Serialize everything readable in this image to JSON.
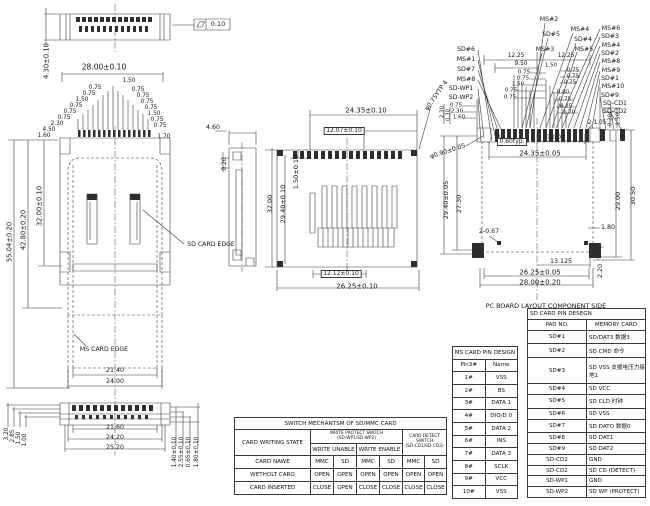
{
  "drawing": {
    "flatness_tolerance": "0.10",
    "annotations": [
      {
        "t": "SD CARD EDGE",
        "x": 211,
        "y": 245,
        "s": 6.2
      },
      {
        "t": "MS CARD EDGE",
        "x": 104,
        "y": 350,
        "s": 6.2
      },
      {
        "t": "PC BOARD LAYOUT COMPONENT SIDE",
        "x": 546,
        "y": 306,
        "s": 6.4
      }
    ],
    "dimensions": [
      {
        "t": "4.30±0.10",
        "x": 47,
        "y": 61,
        "r": -90,
        "s": 6.8
      },
      {
        "t": "0.10",
        "x": 218,
        "y": 24,
        "s": 6.5
      },
      {
        "t": "28.00±0.10",
        "x": 104,
        "y": 67,
        "s": 7.5
      },
      {
        "t": "1.50",
        "x": 129,
        "y": 82,
        "s": 5.8
      },
      {
        "t": "0.75",
        "x": 95,
        "y": 89,
        "s": 5.8
      },
      {
        "t": "0.75",
        "x": 89,
        "y": 95,
        "s": 5.8
      },
      {
        "t": "1.50",
        "x": 82,
        "y": 101,
        "s": 5.8
      },
      {
        "t": "0.75",
        "x": 76,
        "y": 107,
        "s": 5.8
      },
      {
        "t": "0.75",
        "x": 70,
        "y": 113,
        "s": 5.8
      },
      {
        "t": "0.75",
        "x": 64,
        "y": 119,
        "s": 5.8
      },
      {
        "t": "2.30",
        "x": 57,
        "y": 125,
        "s": 5.8
      },
      {
        "t": "4.50",
        "x": 49,
        "y": 131,
        "s": 5.8
      },
      {
        "t": "1.60",
        "x": 44,
        "y": 137,
        "s": 5.8
      },
      {
        "t": "0.75",
        "x": 138,
        "y": 91,
        "s": 5.8
      },
      {
        "t": "0.75",
        "x": 143,
        "y": 97,
        "s": 5.8
      },
      {
        "t": "0.75",
        "x": 147,
        "y": 103,
        "s": 5.8
      },
      {
        "t": "0.75",
        "x": 151,
        "y": 109,
        "s": 5.8
      },
      {
        "t": "1.50",
        "x": 154,
        "y": 115,
        "s": 5.8
      },
      {
        "t": "0.75",
        "x": 157,
        "y": 121,
        "s": 5.8
      },
      {
        "t": "0.75",
        "x": 160,
        "y": 127,
        "s": 5.8
      },
      {
        "t": "1.70",
        "x": 164,
        "y": 138,
        "s": 5.8
      },
      {
        "t": "55.04±0.20",
        "x": 10,
        "y": 242,
        "r": -90,
        "s": 6.8
      },
      {
        "t": "42.80±0.20",
        "x": 24,
        "y": 230,
        "r": -90,
        "s": 6.8
      },
      {
        "t": "32.00±0.10",
        "x": 40,
        "y": 206,
        "r": -90,
        "s": 6.8
      },
      {
        "t": "21.40",
        "x": 115,
        "y": 371,
        "s": 6.3
      },
      {
        "t": "24.00",
        "x": 115,
        "y": 382,
        "s": 6.3
      },
      {
        "t": "3.20",
        "x": 8,
        "y": 434,
        "r": -90,
        "s": 5.8
      },
      {
        "t": "2.85",
        "x": 14,
        "y": 436,
        "r": -90,
        "s": 5.8
      },
      {
        "t": "1.50",
        "x": 20,
        "y": 438,
        "r": -90,
        "s": 5.8
      },
      {
        "t": "1.00",
        "x": 26,
        "y": 440,
        "r": -90,
        "s": 5.8
      },
      {
        "t": "21.60",
        "x": 115,
        "y": 428,
        "s": 6.3
      },
      {
        "t": "24.20",
        "x": 115,
        "y": 438,
        "s": 6.3
      },
      {
        "t": "25.20",
        "x": 115,
        "y": 448,
        "s": 6.3
      },
      {
        "t": "1.40±0.10",
        "x": 176,
        "y": 452,
        "r": -90,
        "s": 5.8
      },
      {
        "t": "2.55±0.10",
        "x": 183,
        "y": 452,
        "r": -90,
        "s": 5.8
      },
      {
        "t": "0.65±0.10",
        "x": 190,
        "y": 452,
        "r": -90,
        "s": 5.8
      },
      {
        "t": "1.80±0.10",
        "x": 198,
        "y": 452,
        "r": -90,
        "s": 5.8
      },
      {
        "t": "4.60",
        "x": 213,
        "y": 128,
        "s": 6.3
      },
      {
        "t": "0.20",
        "x": 226,
        "y": 164,
        "r": -90,
        "s": 5.8
      },
      {
        "t": "24.35±0.10",
        "x": 366,
        "y": 111,
        "s": 7
      },
      {
        "t": "12.07±0.10",
        "x": 344,
        "y": 131,
        "s": 6,
        "box": true
      },
      {
        "t": "32.00",
        "x": 270,
        "y": 204,
        "r": -90,
        "s": 6.5
      },
      {
        "t": "29.40±0.10",
        "x": 283,
        "y": 204,
        "r": -90,
        "s": 6.5
      },
      {
        "t": "1.50±0.10",
        "x": 296,
        "y": 172,
        "r": -90,
        "s": 6.5
      },
      {
        "t": "12.12±0.10",
        "x": 341,
        "y": 274,
        "s": 6,
        "box": true
      },
      {
        "t": "26.25±0.10",
        "x": 357,
        "y": 287,
        "s": 7
      },
      {
        "t": "φ0.75YTP 4",
        "x": 437,
        "y": 96,
        "r": -55,
        "s": 6.2
      },
      {
        "t": "φ0.90±0.05",
        "x": 448,
        "y": 152,
        "r": -18,
        "s": 6.2
      },
      {
        "t": "12.25",
        "x": 516,
        "y": 57,
        "s": 5.8
      },
      {
        "t": "9.50",
        "x": 521,
        "y": 65,
        "s": 5.8
      },
      {
        "t": "12.25",
        "x": 566,
        "y": 57,
        "s": 5.8
      },
      {
        "t": "1.50",
        "x": 551,
        "y": 66,
        "s": 5.5
      },
      {
        "t": "0.75",
        "x": 524,
        "y": 73,
        "s": 5.5
      },
      {
        "t": "0.75",
        "x": 523,
        "y": 79,
        "s": 5.5
      },
      {
        "t": "1.50",
        "x": 518,
        "y": 85,
        "s": 5.5
      },
      {
        "t": "0.75",
        "x": 511,
        "y": 91,
        "s": 5.5
      },
      {
        "t": "0.75",
        "x": 510,
        "y": 98,
        "s": 5.5
      },
      {
        "t": "0.75",
        "x": 573,
        "y": 71,
        "s": 5.5
      },
      {
        "t": "0.75",
        "x": 573,
        "y": 77,
        "s": 5.5
      },
      {
        "t": "0.75",
        "x": 570,
        "y": 83,
        "s": 5.5
      },
      {
        "t": "0.80",
        "x": 563,
        "y": 93,
        "s": 5.5
      },
      {
        "t": "0.75",
        "x": 565,
        "y": 100,
        "s": 5.5
      },
      {
        "t": "6.25",
        "x": 566,
        "y": 107,
        "s": 5.5
      },
      {
        "t": "1.70",
        "x": 569,
        "y": 113,
        "s": 5.5
      },
      {
        "t": "2.30",
        "x": 443,
        "y": 112,
        "r": -90,
        "s": 5.5
      },
      {
        "t": "0.30",
        "x": 449,
        "y": 115,
        "r": -90,
        "s": 5.5
      },
      {
        "t": "0.75",
        "x": 456,
        "y": 106,
        "s": 5.5
      },
      {
        "t": "2.30",
        "x": 457,
        "y": 112,
        "s": 5.5
      },
      {
        "t": "1.60",
        "x": 459,
        "y": 118,
        "s": 5.5
      },
      {
        "t": "2-1.05",
        "x": 597,
        "y": 124,
        "s": 5.8
      },
      {
        "t": "0.20",
        "x": 611,
        "y": 120,
        "r": -90,
        "s": 5.5
      },
      {
        "t": "1.50",
        "x": 619,
        "y": 119,
        "r": -90,
        "s": 5.5
      },
      {
        "t": "0.60typ.",
        "x": 512,
        "y": 142,
        "s": 6,
        "box": true
      },
      {
        "t": "12.07",
        "x": 556,
        "y": 138,
        "s": 6.3
      },
      {
        "t": "24.35±0.05",
        "x": 540,
        "y": 154,
        "s": 7
      },
      {
        "t": "29.40±0.05",
        "x": 446,
        "y": 200,
        "r": -90,
        "s": 6.5
      },
      {
        "t": "27.30",
        "x": 459,
        "y": 204,
        "r": -90,
        "s": 6.5
      },
      {
        "t": "29.00",
        "x": 618,
        "y": 201,
        "r": -90,
        "s": 6.5
      },
      {
        "t": "30.50",
        "x": 633,
        "y": 196,
        "r": -90,
        "s": 6.5
      },
      {
        "t": "2-0.67",
        "x": 489,
        "y": 232,
        "s": 6.3
      },
      {
        "t": "1.80",
        "x": 608,
        "y": 228,
        "s": 6.3
      },
      {
        "t": "13.125",
        "x": 561,
        "y": 262,
        "s": 6.3
      },
      {
        "t": "26.25±0.05",
        "x": 540,
        "y": 273,
        "s": 7
      },
      {
        "t": "28.00±0.20",
        "x": 540,
        "y": 283,
        "s": 7
      },
      {
        "t": "2.20",
        "x": 601,
        "y": 271,
        "r": -90,
        "s": 6.3
      }
    ],
    "pin_callouts": [
      {
        "t": "SD#6",
        "x": 466,
        "y": 50
      },
      {
        "t": "MS#1",
        "x": 466,
        "y": 60
      },
      {
        "t": "SD#7",
        "x": 466,
        "y": 70
      },
      {
        "t": "MS#8",
        "x": 466,
        "y": 80
      },
      {
        "t": "SD-WP1",
        "x": 461,
        "y": 89
      },
      {
        "t": "SD-WP2",
        "x": 461,
        "y": 98
      },
      {
        "t": "MS#2",
        "x": 549,
        "y": 20
      },
      {
        "t": "SD#5",
        "x": 551,
        "y": 35
      },
      {
        "t": "MS#3",
        "x": 545,
        "y": 50
      },
      {
        "t": "MS#4",
        "x": 580,
        "y": 30
      },
      {
        "t": "SD#4",
        "x": 583,
        "y": 40
      },
      {
        "t": "MS#5",
        "x": 584,
        "y": 50
      },
      {
        "t": "MS#6",
        "x": 611,
        "y": 29
      },
      {
        "t": "SD#3",
        "x": 610,
        "y": 37
      },
      {
        "t": "MS#4",
        "x": 611,
        "y": 46
      },
      {
        "t": "SD#2",
        "x": 610,
        "y": 54
      },
      {
        "t": "MS#8",
        "x": 611,
        "y": 62
      },
      {
        "t": "MS#9",
        "x": 611,
        "y": 71
      },
      {
        "t": "SD#1",
        "x": 610,
        "y": 79
      },
      {
        "t": "MS#10",
        "x": 613,
        "y": 87
      },
      {
        "t": "SD#9",
        "x": 610,
        "y": 96
      },
      {
        "t": "SD-CD1",
        "x": 615,
        "y": 104
      },
      {
        "t": "SD-CD2",
        "x": 615,
        "y": 112
      }
    ]
  },
  "tables": {
    "ms": {
      "title": "MS CARD PIN DESIGN",
      "headers": [
        "Pin3#",
        "Name"
      ],
      "rows": [
        [
          "1#",
          "VSS"
        ],
        [
          "2#",
          "BS"
        ],
        [
          "3#",
          "DATA 1"
        ],
        [
          "4#",
          "DIO/D 0"
        ],
        [
          "5#",
          "DATA 2"
        ],
        [
          "6#",
          "INS"
        ],
        [
          "7#",
          "DATA 3"
        ],
        [
          "8#",
          "SCLK"
        ],
        [
          "9#",
          "VCC"
        ],
        [
          "10#",
          "VSS"
        ]
      ]
    },
    "sd": {
      "title": "SD CARD PIN DESEGN",
      "headers": [
        "PAD NO.",
        "MEMORY CARD"
      ],
      "rows": [
        [
          "SD#1",
          "SD/DAT3 数据3"
        ],
        [
          "SD#2",
          "SD CMD 命令"
        ],
        [
          "SD#3",
          "SD VSS 支援电压力接地1"
        ],
        [
          "SD#4",
          "SD VCC"
        ],
        [
          "SD#5",
          "SD CLD 时钟"
        ],
        [
          "SD#6",
          "SD VSS"
        ],
        [
          "SD#7",
          "SD DATO 数据0"
        ],
        [
          "SD#8",
          "SD DAT1"
        ],
        [
          "SD#9",
          "SD DAT2"
        ],
        [
          "SD-CD2",
          "GND"
        ],
        [
          "SD-CD2",
          "SD CD (DETECT)"
        ],
        [
          "SD-WP1",
          "GND"
        ],
        [
          "SD-WP2",
          "SD WP (PROTECT)"
        ]
      ]
    },
    "switch": {
      "title": "SWITCH MECHANTSM OF SD/MMC CARD",
      "col1_header": "CARD WRITING STATE",
      "wp_header": "WRITE PROTECT SWITCH",
      "wp_sub": "(SD-WP1/SD-WP2)",
      "wp_unable": "WRITE UNABLE",
      "wp_enable": "WRITE ENABLE",
      "cd_header": "CARD DETECT SWITCH",
      "cd_sub": "(SD-CD1/SD-CD2)",
      "rows": [
        [
          "CARD NAWE",
          "MMC",
          "SD",
          "MMC",
          "SD",
          "MMC",
          "SD"
        ],
        [
          "WETHOLT CARO",
          "OPEN",
          "OPEN",
          "OPEN",
          "OPEN",
          "OPEN",
          "OPEN"
        ],
        [
          "CARD INSERTED",
          "CLOSE",
          "OPEN",
          "CLOSE",
          "CLOSE",
          "CLOSE",
          "CLOSE"
        ]
      ]
    }
  }
}
